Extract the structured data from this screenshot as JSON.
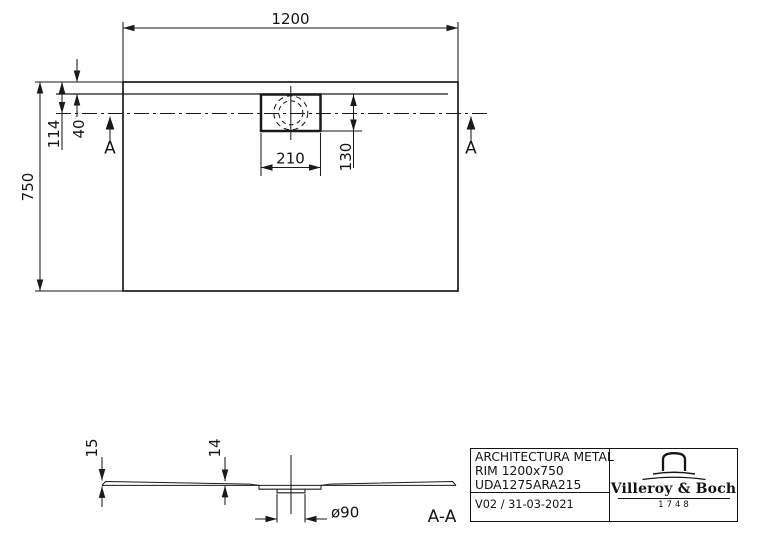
{
  "colors": {
    "ink": "#1a1a1a",
    "background": "#ffffff"
  },
  "top_view": {
    "dim_width": "1200",
    "dim_depth": "750",
    "dim_drain_center_from_edge": "114",
    "dim_rim_offset": "40",
    "dim_drain_box_width": "210",
    "dim_drain_box_depth": "130",
    "section_marker_left": "A",
    "section_marker_right": "A"
  },
  "section_view": {
    "dim_edge_height": "15",
    "dim_body_height": "14",
    "dim_drain_diameter": "ø90",
    "section_label": "A-A"
  },
  "title_block": {
    "line1": "ARCHITECTURA METAL",
    "line2": "RIM 1200x750",
    "line3": "UDA1275ARA215",
    "version_date": "V02 / 31-03-2021",
    "brand_name": "Villeroy & Boch",
    "brand_year": "1748"
  }
}
